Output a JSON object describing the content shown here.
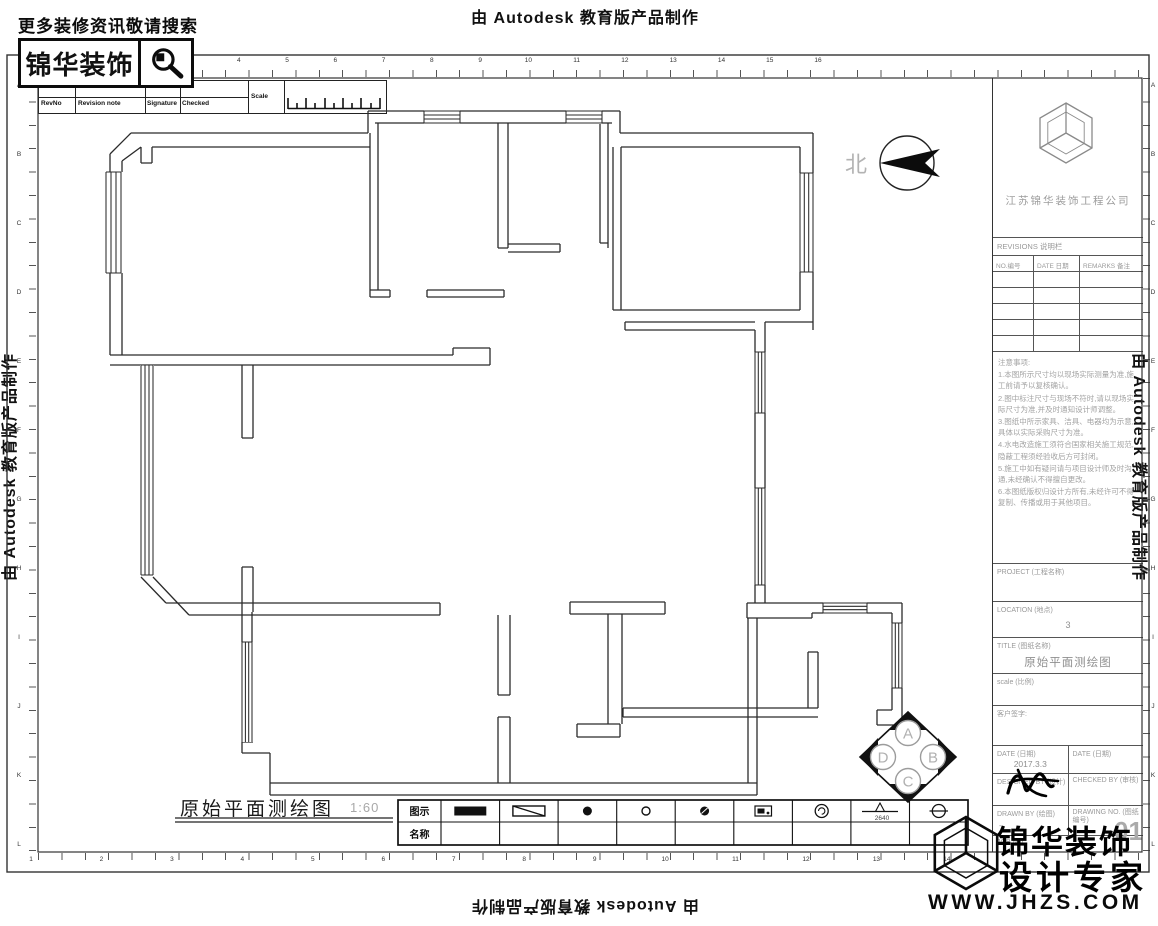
{
  "edge_labels": {
    "top": "由 Autodesk 教育版产品制作",
    "left": "由 Autodesk 教育版产品制作",
    "right": "由 Autodesk 教育版产品制作",
    "bottom": "由 Autodesk 教育版产品制作"
  },
  "header": {
    "search_hint": "更多装修资讯敬请搜索",
    "brand": "锦华装饰"
  },
  "revision_strip": {
    "cols": [
      "RevNo",
      "Revision note",
      "Signature",
      "Checked"
    ],
    "scale_label": "Scale"
  },
  "ruler": {
    "top": [
      "1",
      "2",
      "3",
      "4",
      "5",
      "6",
      "7",
      "8",
      "9",
      "10",
      "11",
      "12",
      "13",
      "14",
      "15",
      "16"
    ],
    "bottom": [
      "1",
      "2",
      "3",
      "4",
      "5",
      "6",
      "7",
      "8",
      "9",
      "10",
      "11",
      "12",
      "13",
      "14"
    ],
    "left": [
      "A",
      "B",
      "C",
      "D",
      "E",
      "F",
      "G",
      "H",
      "I",
      "J",
      "K",
      "L"
    ],
    "right": [
      "A",
      "B",
      "C",
      "D",
      "E",
      "F",
      "G",
      "H",
      "I",
      "J",
      "K",
      "L"
    ]
  },
  "north_label": "北",
  "plan": {
    "title": "原始平面测绘图",
    "scale": "1:60"
  },
  "compass": {
    "a": "A",
    "b": "B",
    "c": "C",
    "d": "D"
  },
  "legend": {
    "symbol_row_label": "图示",
    "name_row_label": "名称",
    "items": [
      {
        "icon": "main-electric-box-icon",
        "name": "总电箱"
      },
      {
        "icon": "weak-electric-box-icon",
        "name": "弱电箱"
      },
      {
        "icon": "toilet-drain-icon",
        "name": "马桶下水"
      },
      {
        "icon": "drain-pipe-icon",
        "name": "下水管"
      },
      {
        "icon": "floor-drain-icon",
        "name": "地漏"
      },
      {
        "icon": "gas-meter-icon",
        "name": "燃气表"
      },
      {
        "icon": "ac-hole-icon",
        "name": "空调洞口"
      },
      {
        "icon": "ceiling-height-icon",
        "name": "层高",
        "value": "2640"
      },
      {
        "icon": "water-supply-icon",
        "name": "上水位"
      }
    ]
  },
  "title_block": {
    "company": "江苏锦华装饰工程公司",
    "revisions_header": "REVISIONS 说明栏",
    "rev_cols": [
      "NO.编号",
      "DATE 日期",
      "REMARKS 备注"
    ],
    "notes_title": "注意事项:",
    "notes": [
      "1.本图所示尺寸均以现场实际测量为准,施工前请予以复核确认。",
      "2.图中标注尺寸与现场不符时,请以现场实际尺寸为准,并及时通知设计师调整。",
      "3.图纸中所示家具、洁具、电器均为示意,具体以实际采购尺寸为准。",
      "4.水电改造施工须符合国家相关施工规范,隐蔽工程须经验收后方可封闭。",
      "5.施工中如有疑问请与项目设计师及时沟通,未经确认不得擅自更改。",
      "6.本图纸版权归设计方所有,未经许可不得复制、传播或用于其他项目。"
    ],
    "fields": {
      "project_label": "PROJECT (工程名称)",
      "location_label": "LOCATION (地点)",
      "location_value": "3",
      "title_label": "TITLE (图纸名称)",
      "title_value": "原始平面测绘图",
      "scale_label": "scale (比例)",
      "client_label": "客户签字:",
      "date_label": "DATE (日期)",
      "date_value": "2017.3.3",
      "date2_label": "DATE (日期)",
      "designed_label": "DESIGNED BY (设计)",
      "checked_label": "CHECKED BY (审核)",
      "drawn_label": "DRAWN BY (绘图)",
      "drawn_value": "-",
      "drawing_no_label": "DRAWING NO. (图纸编号)",
      "drawing_no_value": "01",
      "job_label": "JOB NO."
    }
  },
  "footer_logo": {
    "brand_line1": "锦华装饰",
    "brand_line2": "设计专家",
    "website": "WWW.JHZS.COM"
  },
  "colors": {
    "line": "#2b2b2b",
    "gray": "#9c9c9c",
    "black": "#111111"
  }
}
